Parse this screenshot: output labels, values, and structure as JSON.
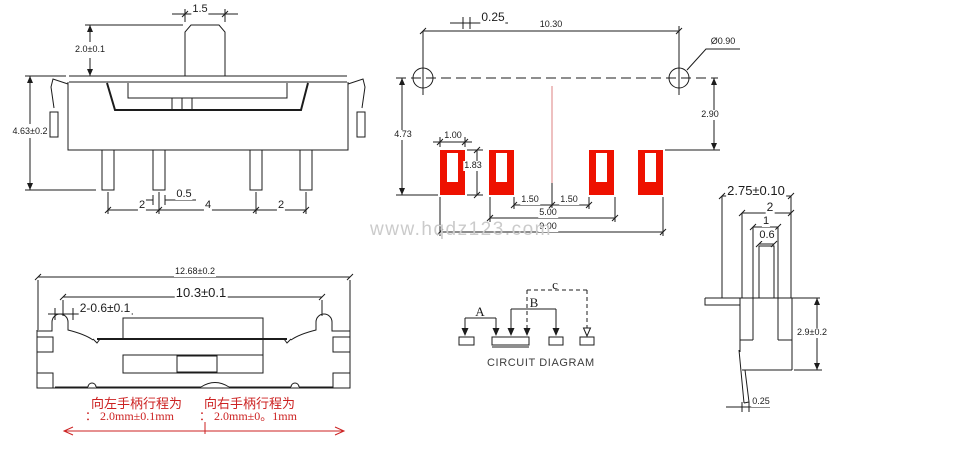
{
  "front_view": {
    "knob_width": "1.5",
    "knob_height": "2.0±0.1",
    "body_height": "4.63±0.2",
    "pin_pitch_left": "2",
    "pin_width": "0.5",
    "pin_pitch_center": "4",
    "pin_pitch_right": "2"
  },
  "pcb_view": {
    "offset": "0.25",
    "hole_pitch": "10.30",
    "hole_diameter": "Ø0.90",
    "hole_to_pad": "2.90",
    "overall_height": "4.73",
    "pad_width": "1.00",
    "pad_height": "1.83",
    "pitch_a": "1.50",
    "pitch_b": "1.50",
    "span_inner": "5.00",
    "span_outer": "9.00"
  },
  "side_view": {
    "top_width": "2.75±0.10",
    "step_width": "2",
    "stem_width": "1",
    "knob_width": "0.6",
    "body_height": "2.9±0.2",
    "pin_thickness": "0.25"
  },
  "top_view": {
    "overall_length": "12.68±0.2",
    "slot_length": "10.3±0.1",
    "notch": "2-0.6±0.1",
    "left_note_line1": "向左手柄行程为",
    "left_note_line2": "： 2.0mm±0.1mm",
    "right_note_line1": "向右手柄行程为",
    "right_note_line2": "： 2.0mm±0。1mm"
  },
  "circuit": {
    "label_a": "A",
    "label_b": "B",
    "label_c": "c",
    "title": "CIRCUIT DIAGRAM"
  },
  "watermark": "www.hqdz123.com",
  "colors": {
    "line": "#1c1c1c",
    "pad_red": "#ee1100",
    "annotation_red": "#cc2222",
    "centerline_red": "#dd8080",
    "watermark_gray": "#cbcbcb"
  }
}
